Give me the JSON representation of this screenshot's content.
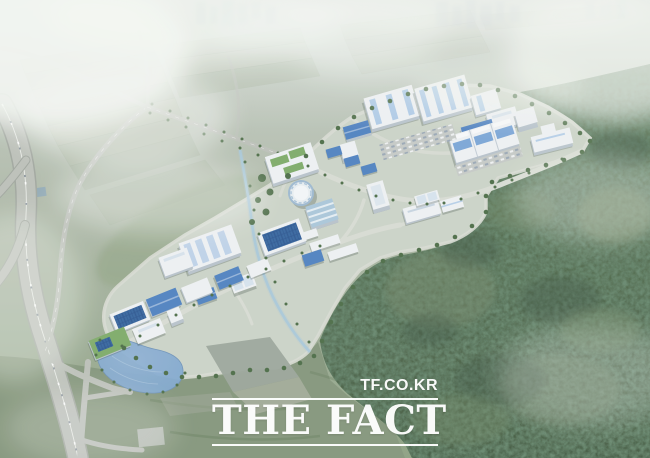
{
  "meta": {
    "type": "aerial-rendering",
    "subject": "Bird's-eye architectural rendering of a planned industrial complex set among misty farmland, an expressway interchange and forested hills",
    "width": 650,
    "height": 458
  },
  "watermark": {
    "site_url": "TF.CO.KR",
    "brand": "THE FACT"
  },
  "palette": {
    "haze": "#eef3ee",
    "farm-light": "#b6bfab",
    "farm-dark": "#9cab94",
    "forest-mid": "#5d7757",
    "forest-dark": "#41593f",
    "meadow": "#83957a",
    "road-light": "#d8dcd3",
    "highway-grey": "#bcc0b9",
    "building-white": "#eef1f4",
    "building-side": "#b7c2cb",
    "roof-blue": "#4d80c0",
    "solar-blue": "#34659f",
    "roof-green": "#7cab67",
    "pond-blue": "#7ba4cd",
    "canal-blue": "#a6c8da",
    "tree-green": "#4a6b44",
    "cloud-white": "#f5f8f4",
    "watermark-white": "#ffffff"
  },
  "scene": {
    "regions": [
      {
        "name": "distant-city-skyline"
      },
      {
        "name": "misty-farmland"
      },
      {
        "name": "expressway-interchange"
      },
      {
        "name": "access-roads"
      },
      {
        "name": "industrial-complex"
      },
      {
        "name": "factory-halls"
      },
      {
        "name": "office-towers"
      },
      {
        "name": "solar-roof-buildings"
      },
      {
        "name": "retention-pond"
      },
      {
        "name": "stream-canal"
      },
      {
        "name": "forest-hills"
      },
      {
        "name": "meadow"
      },
      {
        "name": "clouds-mist"
      }
    ]
  }
}
